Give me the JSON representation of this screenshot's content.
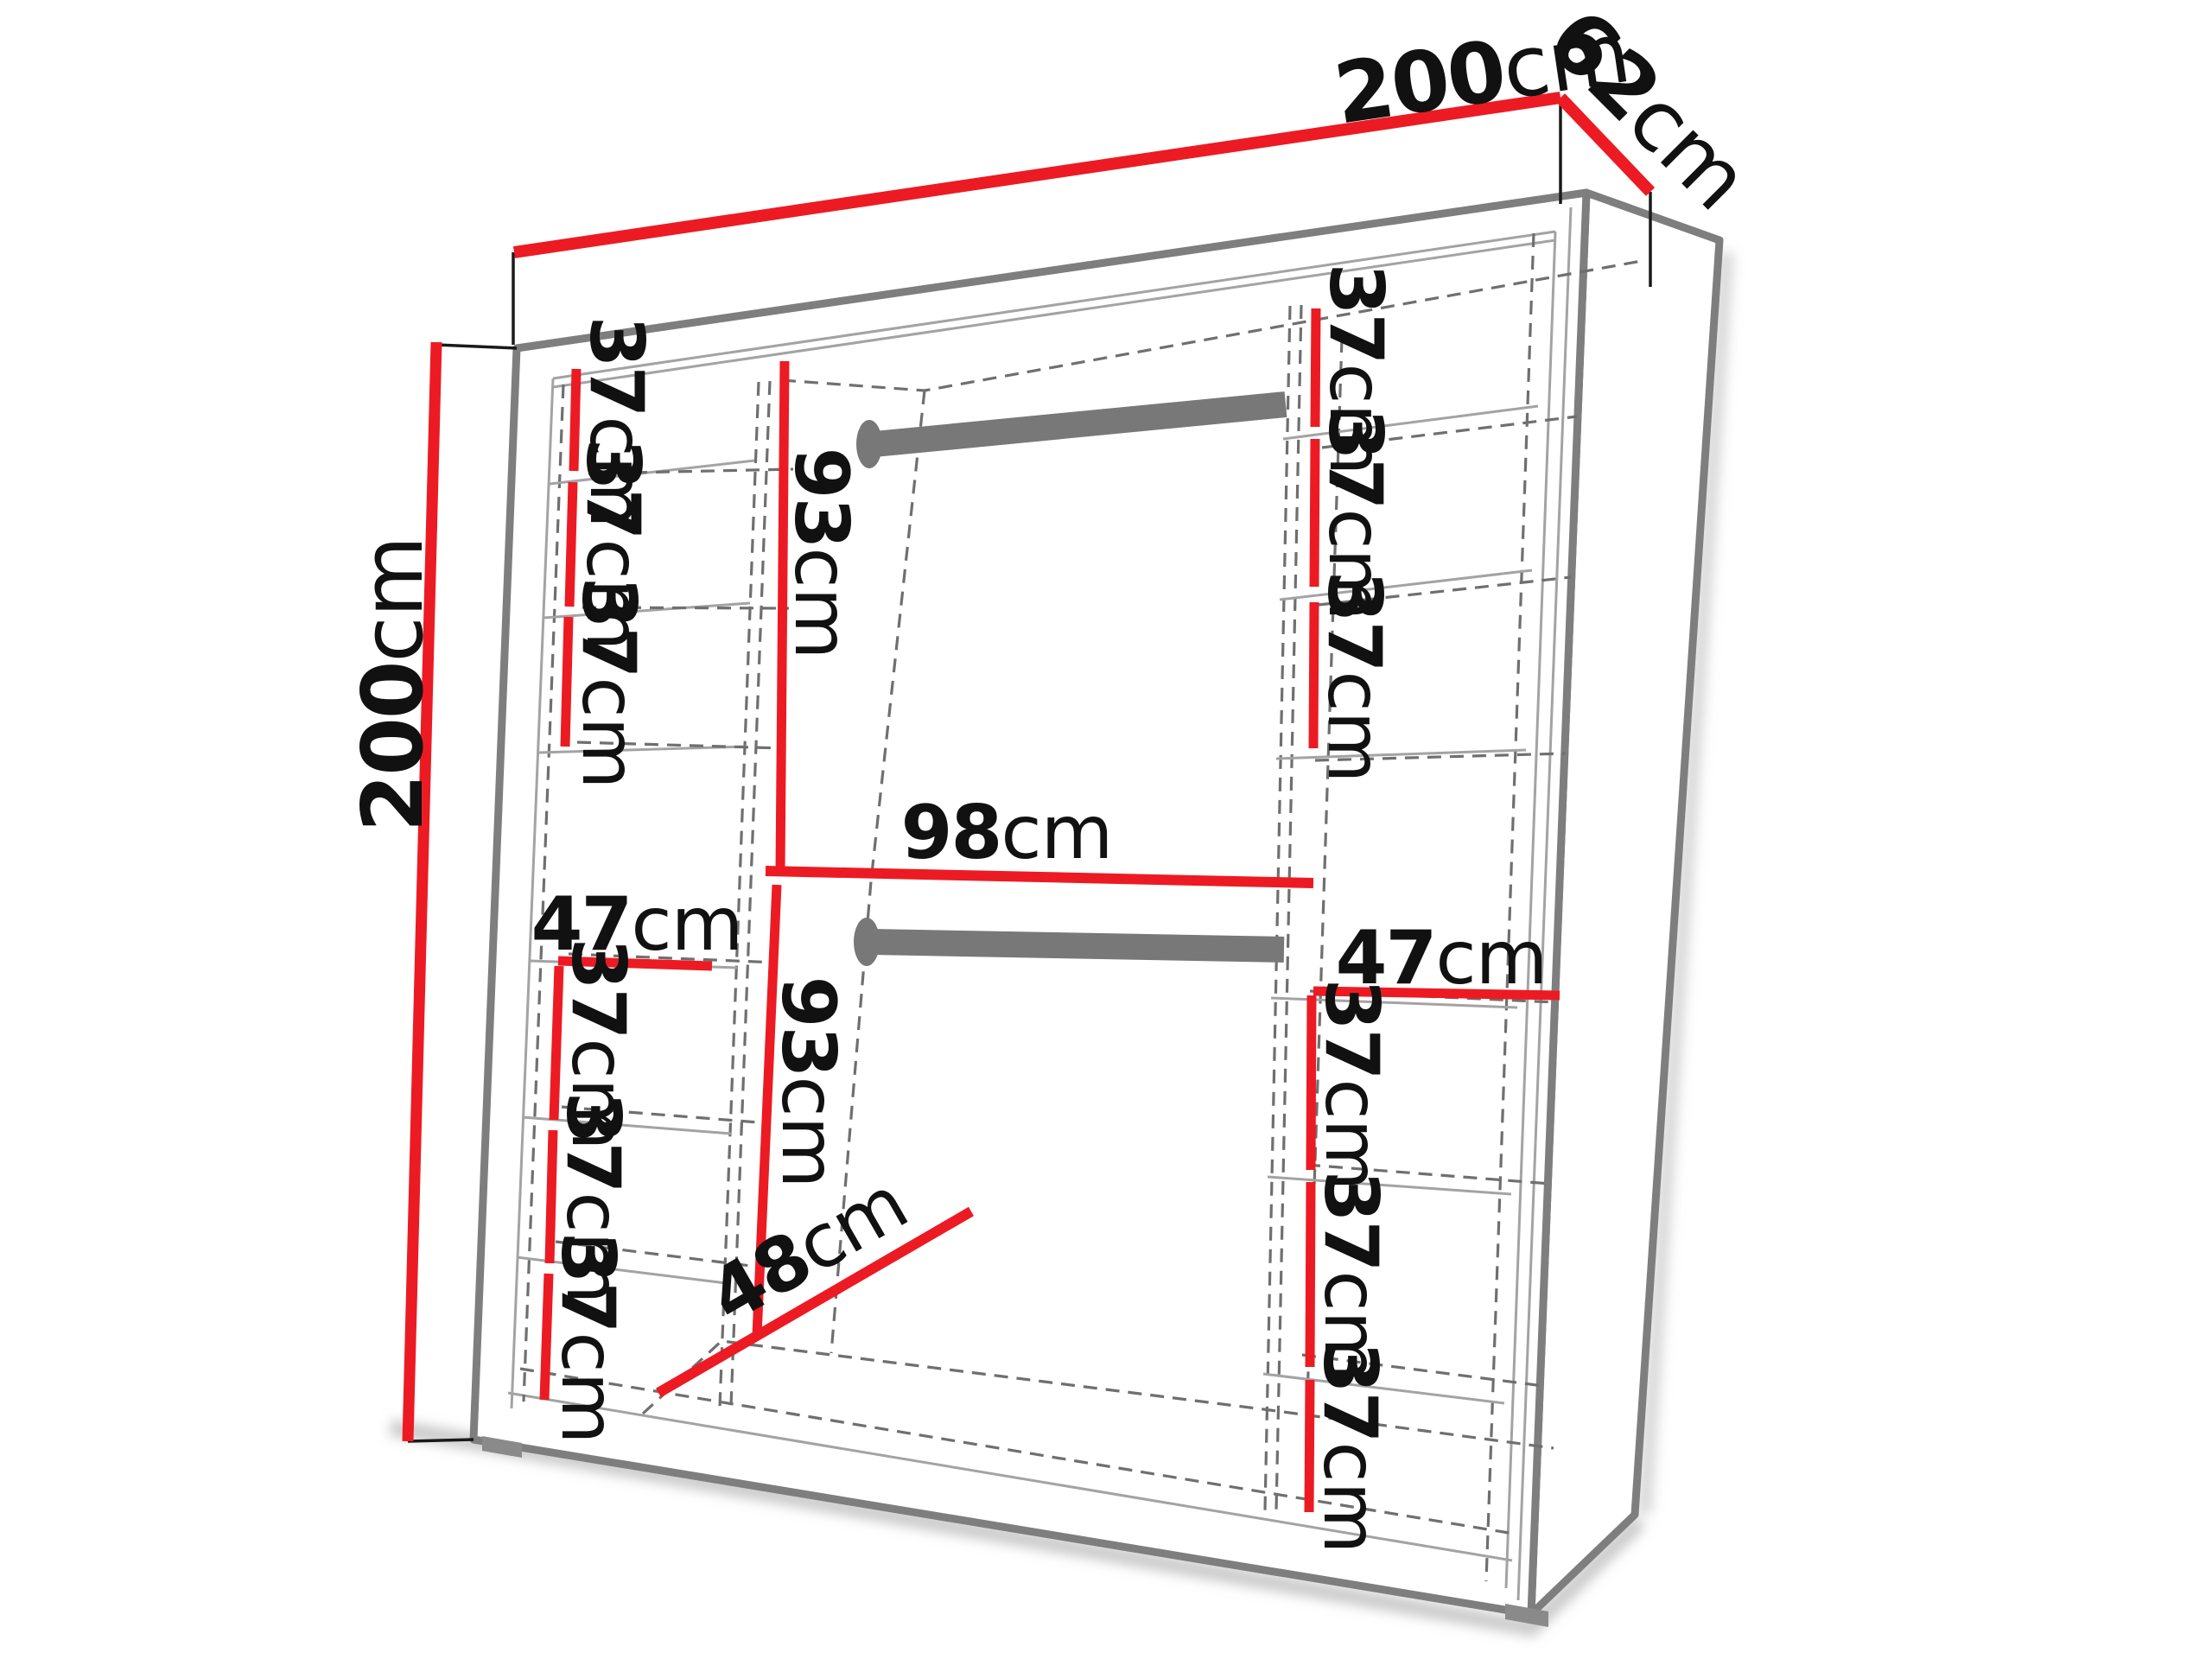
{
  "diagram": {
    "type": "wardrobe-dimension-diagram",
    "unit": "cm",
    "colors": {
      "dimension_line": "#ec1b23",
      "structure_edge": "#7e7e7e",
      "rail": "#787878",
      "text": "#111111",
      "background": "#ffffff"
    },
    "overall": {
      "width": {
        "value": "200",
        "unit": "cm"
      },
      "depth": {
        "value": "62",
        "unit": "cm"
      },
      "height": {
        "value": "200",
        "unit": "cm"
      }
    },
    "left_column": {
      "width": {
        "value": "47",
        "unit": "cm"
      },
      "gaps": [
        {
          "value": "37",
          "unit": "cm"
        },
        {
          "value": "37",
          "unit": "cm"
        },
        {
          "value": "37",
          "unit": "cm"
        },
        {
          "value": "37",
          "unit": "cm"
        },
        {
          "value": "37",
          "unit": "cm"
        },
        {
          "value": "37",
          "unit": "cm"
        }
      ]
    },
    "right_column": {
      "width": {
        "value": "47",
        "unit": "cm"
      },
      "gaps": [
        {
          "value": "37",
          "unit": "cm"
        },
        {
          "value": "37",
          "unit": "cm"
        },
        {
          "value": "37",
          "unit": "cm"
        },
        {
          "value": "37",
          "unit": "cm"
        },
        {
          "value": "37",
          "unit": "cm"
        },
        {
          "value": "37",
          "unit": "cm"
        }
      ]
    },
    "middle_section": {
      "width": {
        "value": "98",
        "unit": "cm"
      },
      "upper_height": {
        "value": "93",
        "unit": "cm"
      },
      "lower_height": {
        "value": "93",
        "unit": "cm"
      },
      "floor_depth": {
        "value": "48",
        "unit": "cm"
      },
      "rail_count": "2"
    }
  }
}
